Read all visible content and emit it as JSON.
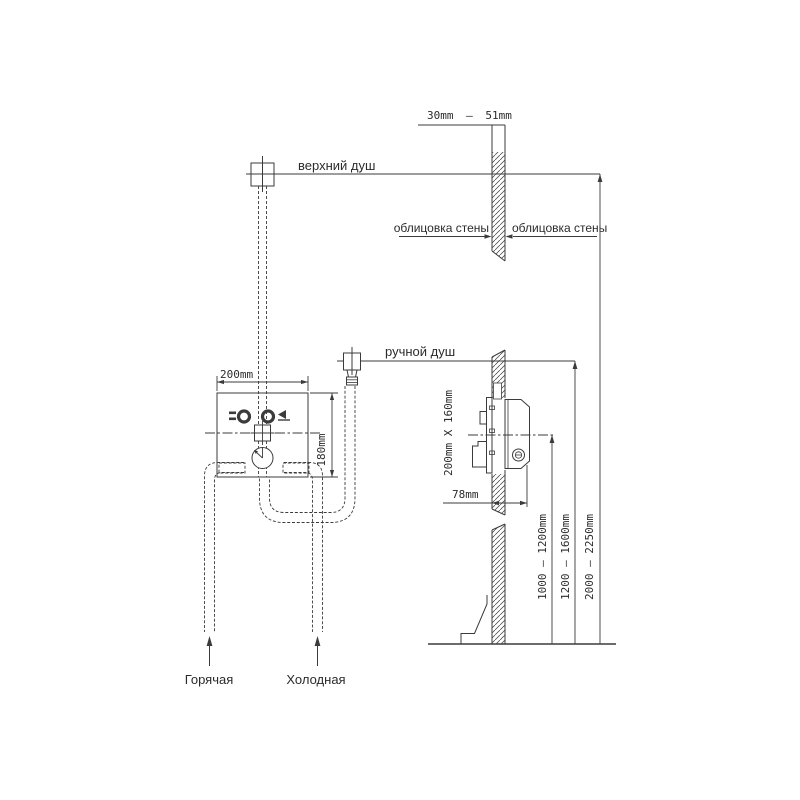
{
  "diagram": {
    "labels": {
      "overhead_shower": "верхний душ",
      "hand_shower": "ручной душ",
      "wall_cladding_left": "облицовка стены",
      "wall_cladding_right": "облицовка стены",
      "hot_supply": "Горячая",
      "cold_supply": "Холодная"
    },
    "dimensions": {
      "cladding_thickness": "30mm — 51mm",
      "box_width": "200mm",
      "box_height": "180mm",
      "rough_in_size": "200mm X 160mm",
      "rough_in_depth": "78mm",
      "mixer_height_range": "1000 — 1200mm",
      "hand_shower_height_range": "1200 — 1600mm",
      "overhead_height_range": "2000 — 2250mm"
    },
    "colors": {
      "line": "#3b3b3b",
      "text": "#2b2b2b",
      "background": "#ffffff"
    }
  }
}
